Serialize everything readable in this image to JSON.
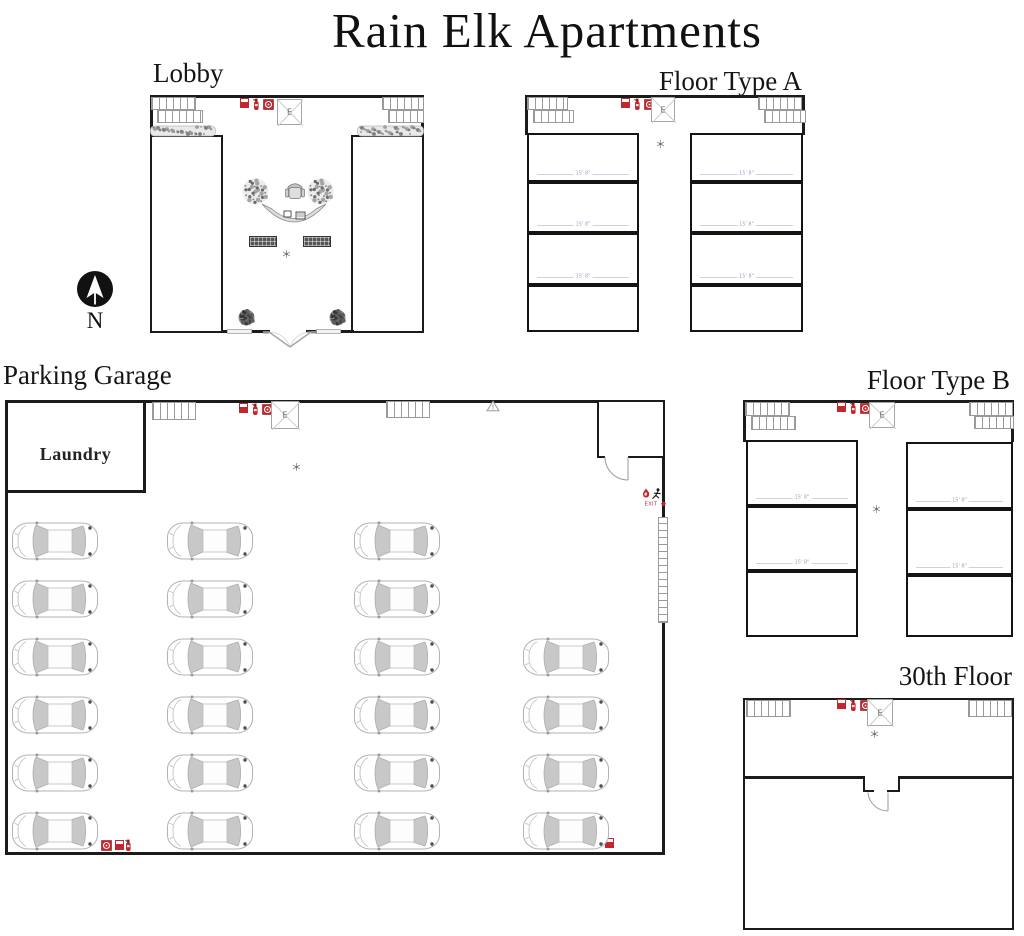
{
  "title": "Rain Elk Apartments",
  "sections": {
    "lobby": {
      "label": "Lobby"
    },
    "floor_a": {
      "label": "Floor Type A",
      "units_left": 4,
      "units_right": 4
    },
    "parking": {
      "label": "Parking Garage",
      "laundry_label": "Laundry",
      "car_count": 22
    },
    "floor_b": {
      "label": "Floor Type B",
      "units_left": 3,
      "units_right": 3
    },
    "floor_30": {
      "label": "30th Floor"
    }
  },
  "compass_label": "N",
  "elevator_label": "E",
  "exit_sign_text": "EXIT",
  "unit_dimension": "15' 8\"",
  "parking_grid": {
    "columns": 4,
    "rows": 6,
    "occupied": [
      [
        1,
        1,
        1,
        1,
        1,
        1
      ],
      [
        1,
        1,
        1,
        1,
        1,
        1
      ],
      [
        1,
        1,
        1,
        1,
        1,
        1
      ],
      [
        0,
        0,
        1,
        1,
        1,
        1
      ]
    ]
  },
  "colors": {
    "wall": "#1b1b1b",
    "safety_red": "#c3272e",
    "stair_gray": "#9a9a9a",
    "car_gray": "#c8c8c8",
    "dimension_text": "#9aa5ba"
  }
}
